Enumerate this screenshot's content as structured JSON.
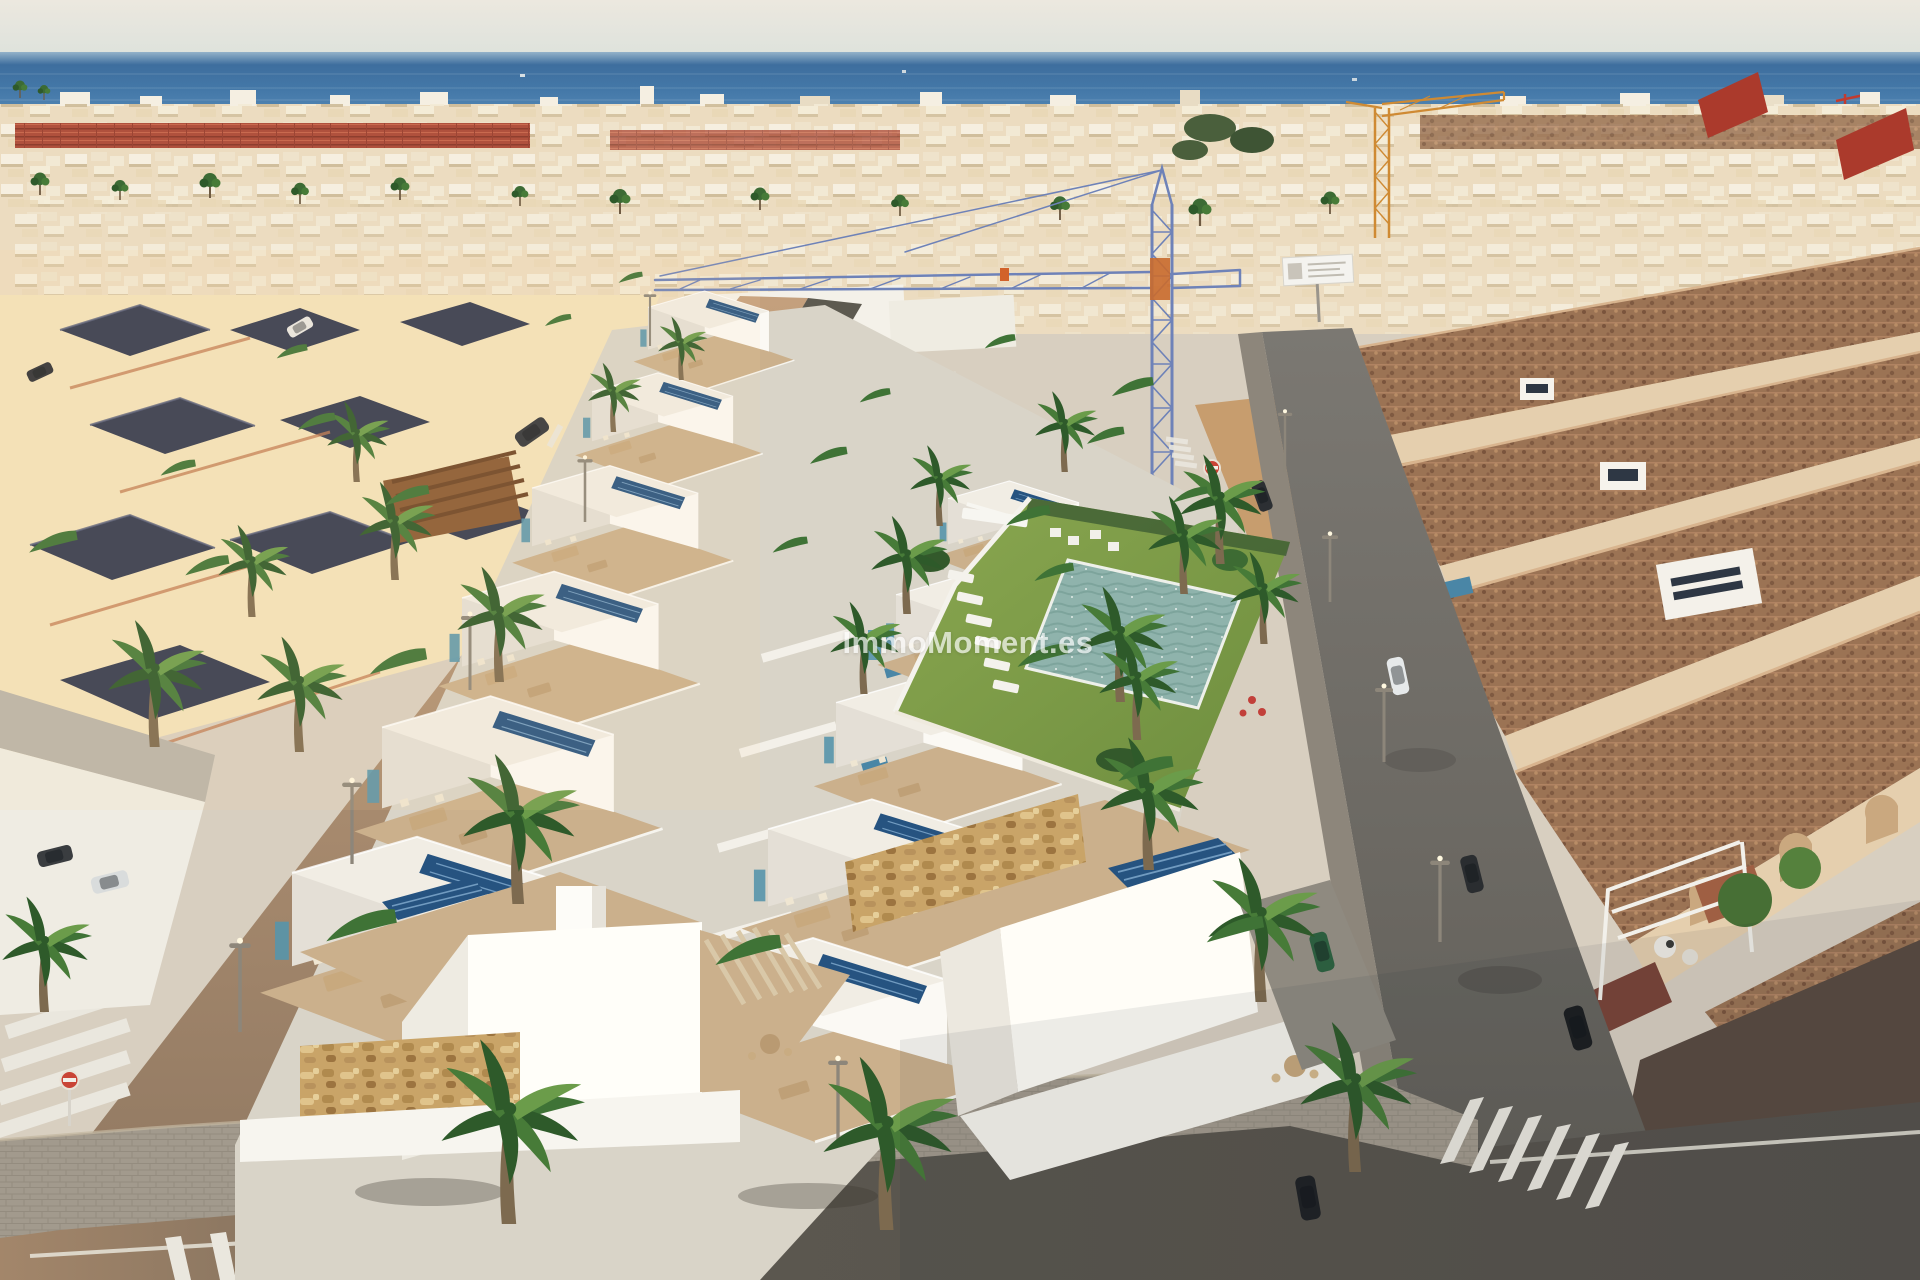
{
  "watermark": {
    "text": "ImmoMoment.es"
  },
  "palette": {
    "watermark_color": "#ffffff",
    "watermark_opacity": "0.68",
    "sky": "#e9e5dc",
    "sea": "#3f6f9f",
    "city": "#ecdcc0",
    "red_roof": "#b0513d",
    "cream": "#f3e2ba",
    "dark_roof": "#343a50",
    "sand": "#c79d6e",
    "villa_white": "#fbf9f4",
    "villa_shade": "#e4dfd6",
    "terrace": "#cbb08c",
    "solar": "#265380",
    "teal": "#5795ab",
    "lawn": "#7e9c46",
    "palm_green": "#3f7336",
    "pool": "#8fb3ac",
    "private_pool": "#4a86a6",
    "road_warm": "#b3906f",
    "road_gray": "#716e68",
    "road_dark": "#55514b",
    "sidewalk": "#a29a8d",
    "stripe": "#eae7de",
    "stone": "#c9a468",
    "terra_roof": "#9b7354",
    "red_gable": "#ab3a2c",
    "beige_wall": "#e5cfae",
    "crane_blue": "#6e82b8",
    "crane_orange": "#cf8a33",
    "lamp": "#8d867a",
    "hedge": "#5d5a50"
  }
}
